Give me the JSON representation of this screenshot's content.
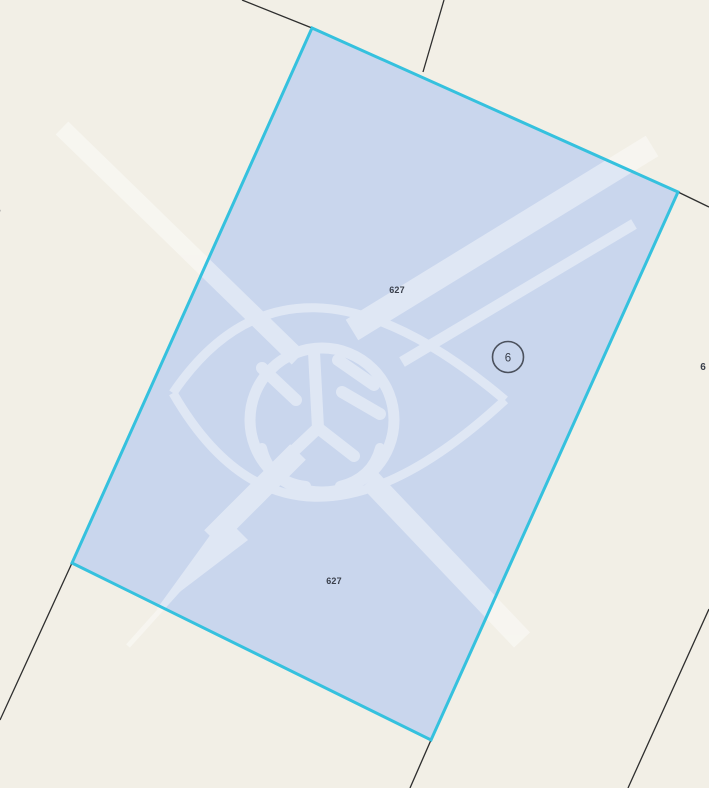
{
  "map": {
    "selected_parcel": {
      "parcel_number_top": "627",
      "parcel_number_bottom": "627",
      "building_badge_number": "6"
    },
    "edge_labels": {
      "left_partial": "5",
      "right_partial": "6"
    },
    "colors": {
      "background": "#f2efe6",
      "parcel_fill": "rgba(168,193,243,0.55)",
      "parcel_border": "#35c1de",
      "boundary_line": "#2e2e2e",
      "label_text": "#3a404c",
      "badge_ring": "#4b515d",
      "watermark_opacity": "0.42"
    }
  }
}
